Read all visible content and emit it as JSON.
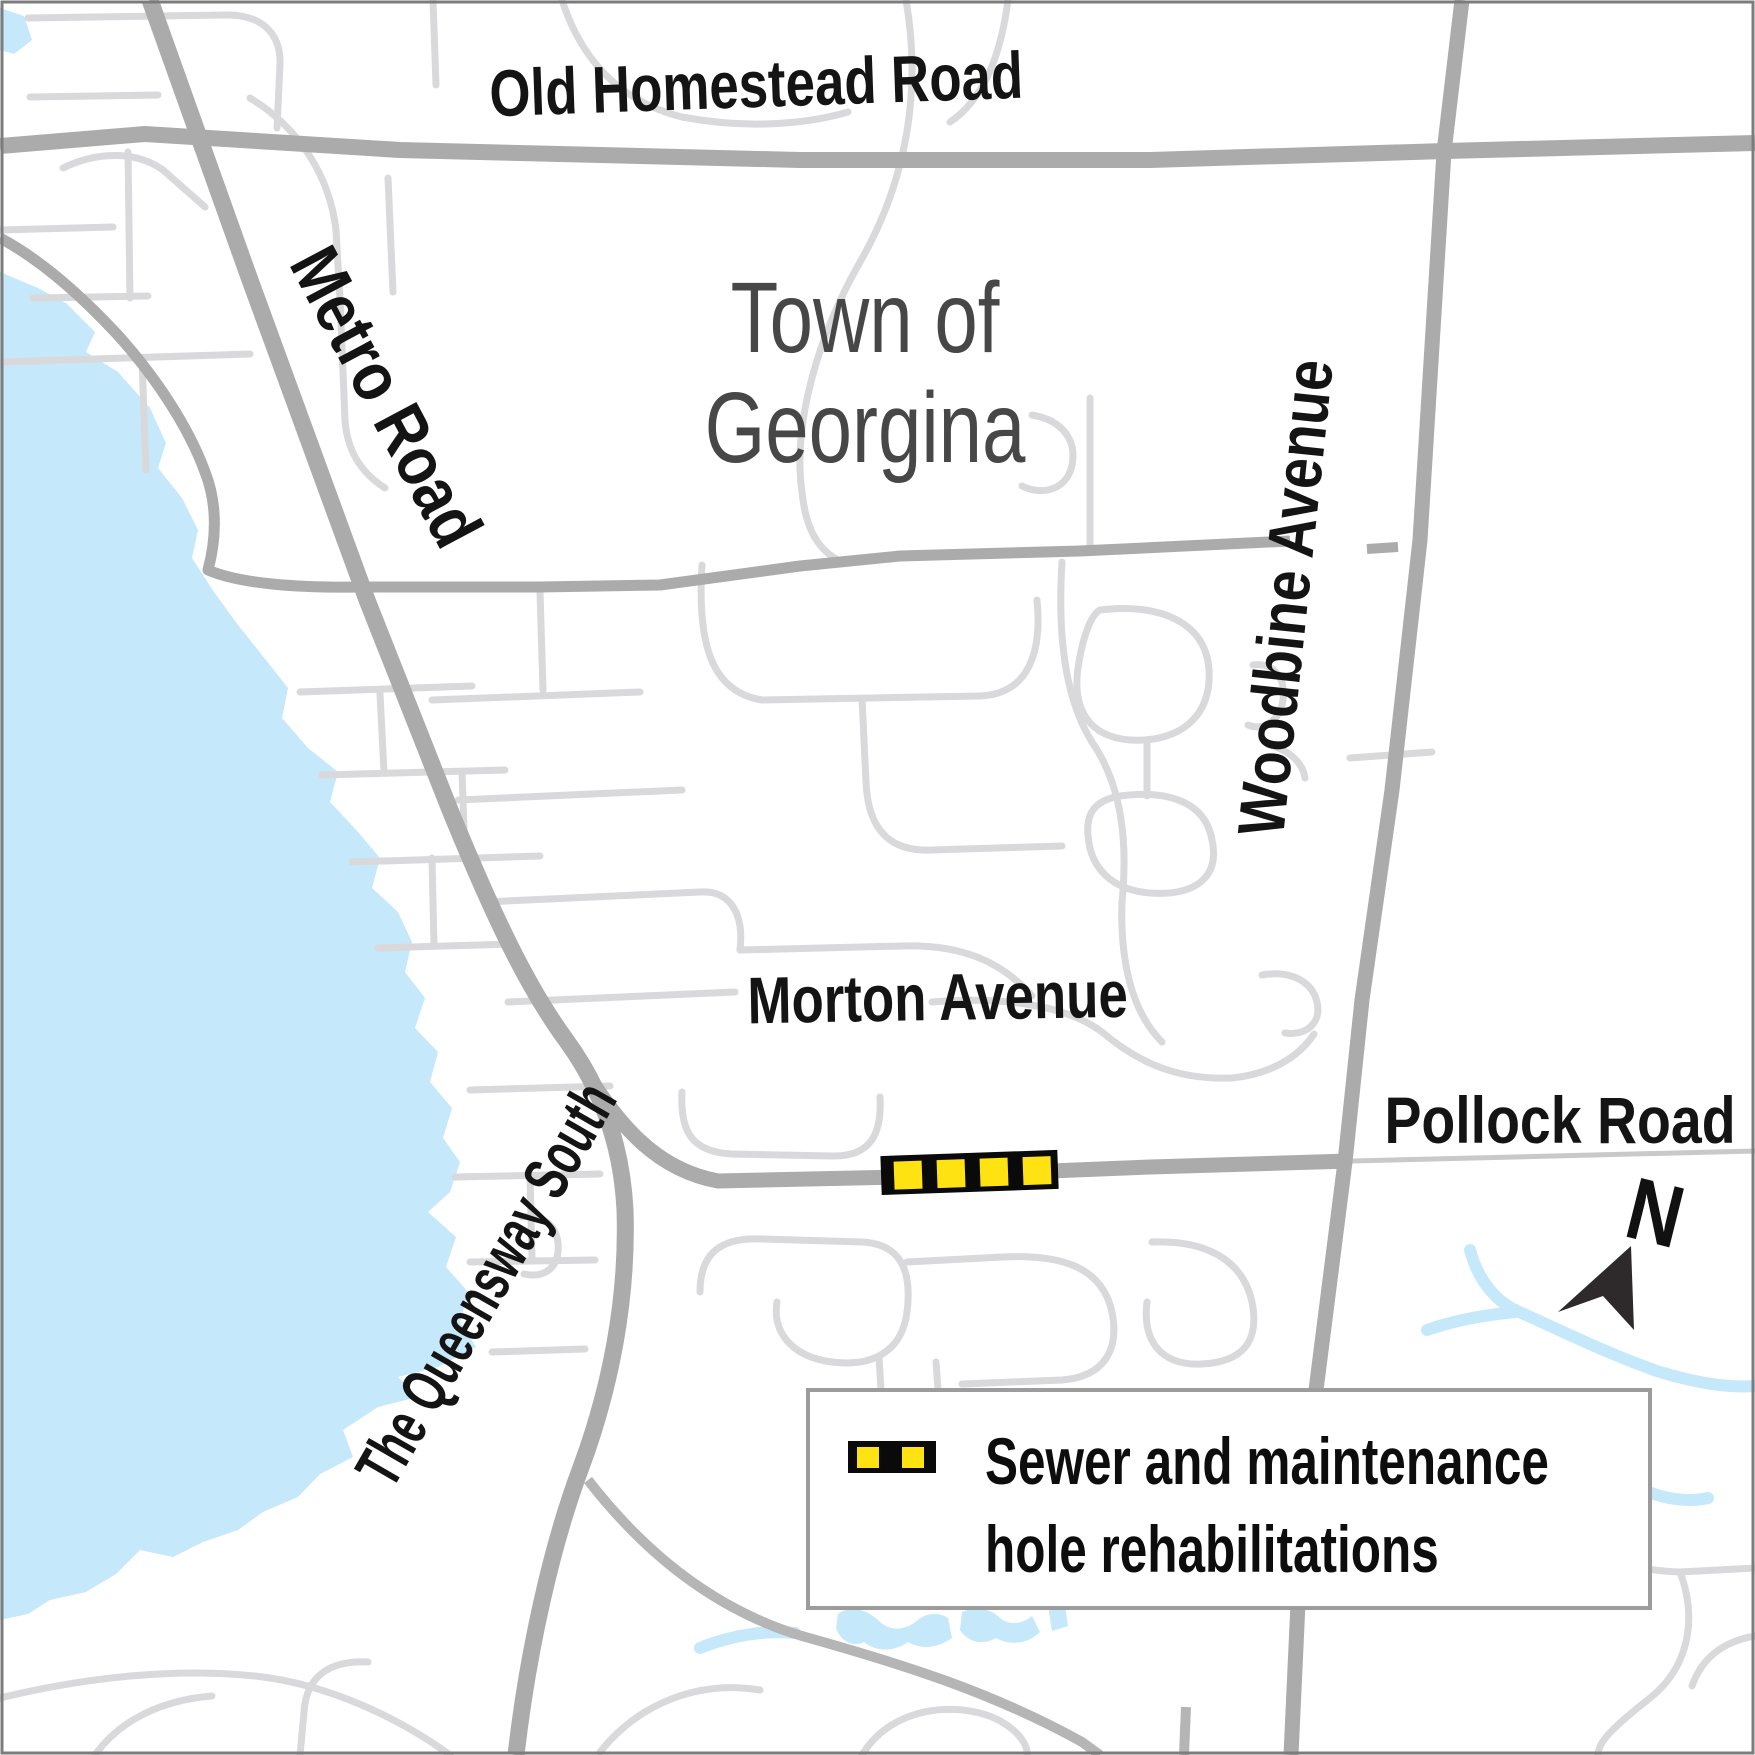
{
  "map": {
    "region": {
      "name_line1": "Town of",
      "name_line2": "Georgina"
    },
    "roads": {
      "old_homestead": {
        "label": "Old Homestead Road"
      },
      "metro": {
        "label": "Metro Road"
      },
      "woodbine": {
        "label": "Woodbine Avenue"
      },
      "morton": {
        "label": "Morton Avenue"
      },
      "pollock": {
        "label": "Pollock Road"
      },
      "queensway": {
        "label": "The Queensway South"
      }
    },
    "legend": {
      "items": [
        {
          "symbol": "sewer-rehab-marker",
          "label_line1": "Sewer and maintenance",
          "label_line2": "hole rehabilitations"
        }
      ]
    },
    "north_arrow": {
      "label": "N"
    },
    "colors": {
      "water": "#C5E8FB",
      "road_major": "#ABABAB",
      "road_minor": "#D9D9DB",
      "marker_yellow": "#FFE212",
      "marker_black": "#0A0A0A",
      "label_dark": "#141414",
      "region_label_gray": "#474747"
    }
  }
}
